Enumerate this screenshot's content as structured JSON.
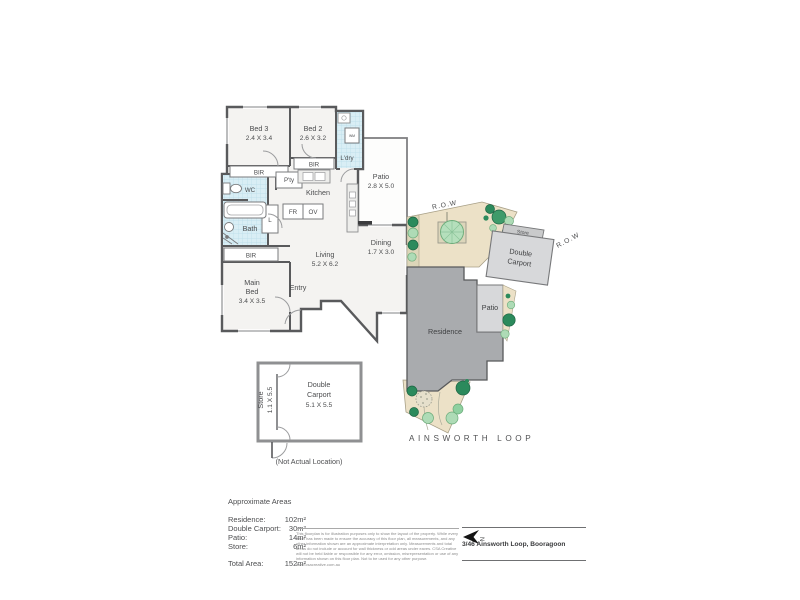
{
  "floor_plan": {
    "bed3": {
      "label": "Bed 3",
      "dims": "2.4 X 3.4"
    },
    "bed2": {
      "label": "Bed 2",
      "dims": "2.6 X 3.2"
    },
    "laundry_label": "L'dry",
    "wm_label": "WM",
    "bir_label": "BIR",
    "pantry_label": "P'ty",
    "kitchen_label": "Kitchen",
    "fridge_label": "FR",
    "oven_label": "OV",
    "wc_label": "WC",
    "bath_label": "Bath",
    "linen_label": "L",
    "patio": {
      "label": "Patio",
      "dims": "2.8 X 5.0"
    },
    "living": {
      "label": "Living",
      "dims": "5.2 X 6.2"
    },
    "dining": {
      "label": "Dining",
      "dims": "1.7 X 3.0"
    },
    "main_bed": {
      "line1": "Main",
      "line2": "Bed",
      "dims": "3.4 X 3.5"
    },
    "entry_label": "Entry"
  },
  "site_plan": {
    "row_label": "R.O.W",
    "store_label": "Store",
    "carport_line1": "Double",
    "carport_line2": "Carport",
    "patio_label": "Patio",
    "residence_label": "Residence",
    "street_label": "AINSWORTH LOOP"
  },
  "carport_plan": {
    "store_label": "Store",
    "store_dims": "1.1 X 5.5",
    "line1": "Double",
    "line2": "Carport",
    "dims": "5.1 X 5.5",
    "note": "(Not Actual Location)"
  },
  "areas": {
    "title": "Approximate Areas",
    "rows": [
      {
        "label": "Residence:",
        "value": "102m²"
      },
      {
        "label": "Double Carport:",
        "value": "30m²"
      },
      {
        "label": "Patio:",
        "value": "14m²"
      },
      {
        "label": "Store:",
        "value": "6m²"
      }
    ],
    "total_label": "Total Area:",
    "total_value": "152m²"
  },
  "footer": {
    "disclaimer": "This floorplan is for illustration purposes only to show the layout of the property. While every effort has been made to ensure the accuracy of this floor plan, all measurements, and any other information shown are an approximate interpretation only. Measurements and total areas do not include or account for wall thickness or odd areas under eaves. CSA Creative will not be held liable or responsible for any error, omission, misrepresentation or use of any information shown on this floor plan. Not to be used for any other purpose.",
    "website": "www.csacreative.com.au",
    "address": "3/46 Ainsworth Loop, Booragoon",
    "north_label": "N"
  },
  "colors": {
    "wall": "#595a5c",
    "floor": "#f4f3f1",
    "tile": "#d9eef5",
    "land": "#ece1c7",
    "residence": "#a9abae",
    "hardstand": "#d7d8da",
    "tree_dark": "#2b8a5c",
    "tree_light": "#aedbb6"
  }
}
